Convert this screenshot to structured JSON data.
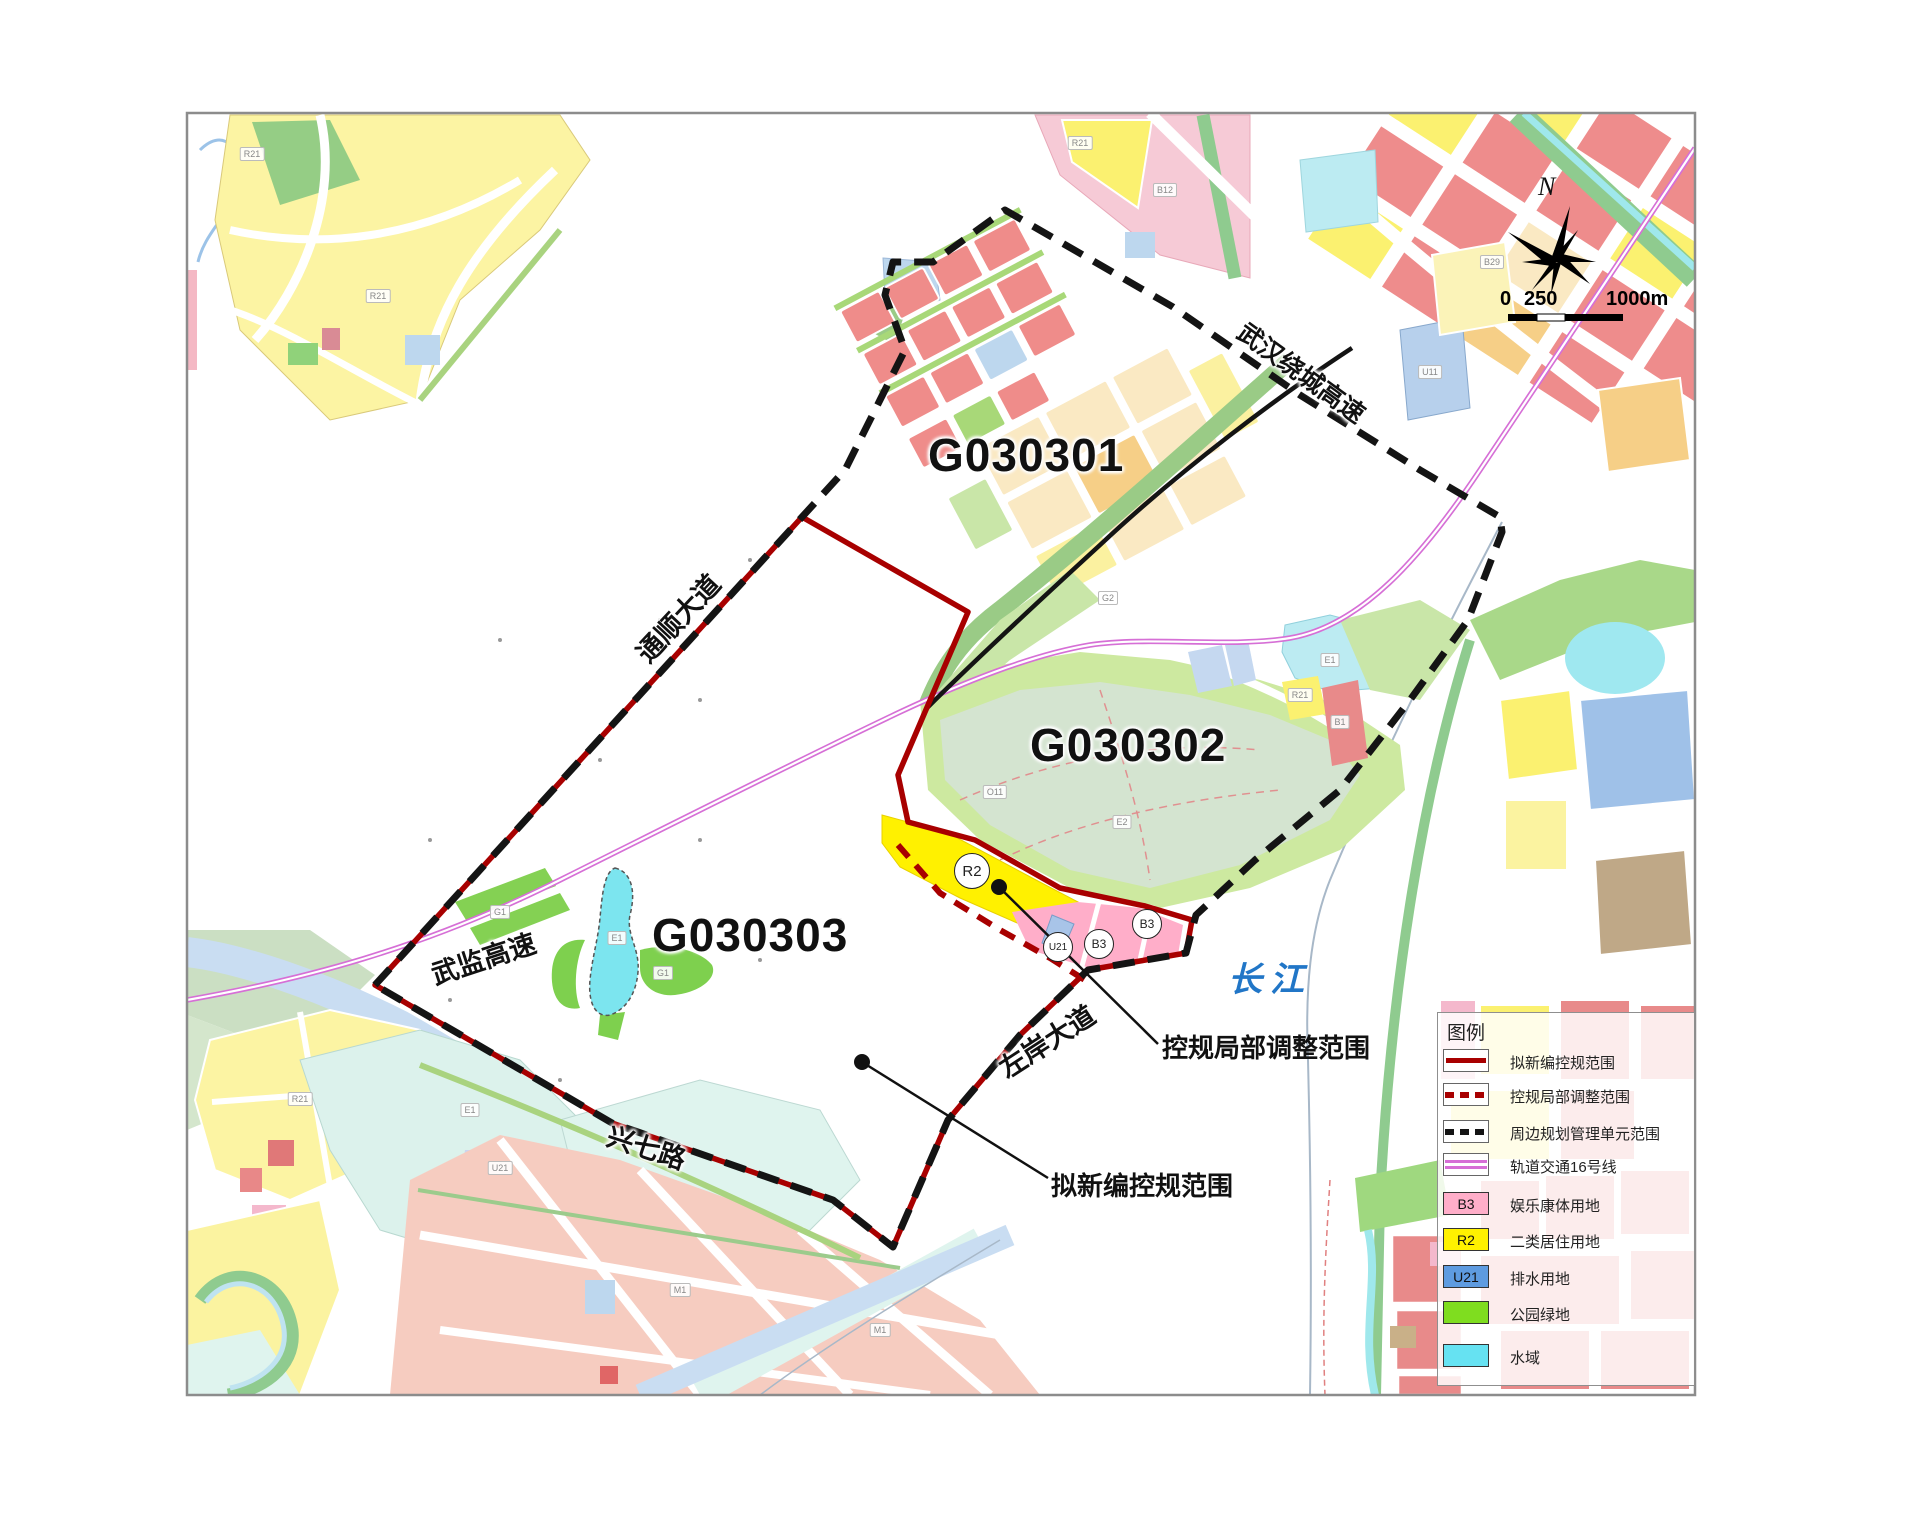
{
  "map": {
    "units": {
      "u1": "G030301",
      "u2": "G030302",
      "u3": "G030303"
    },
    "roads": {
      "tongshun": "通顺大道",
      "wujian": "武监高速",
      "xingqi": "兴七路",
      "zuoan": "左岸大道",
      "raocheng": "武汉绕城高速"
    },
    "river_label": "长江",
    "callouts": {
      "adjust": "控规局部调整范围",
      "new_plan": "拟新编控规范围"
    },
    "badges": {
      "r2": "R2",
      "b3a": "B3",
      "b3b": "B3",
      "u21": "U21"
    },
    "chips": [
      {
        "t": "R21",
        "x": 378,
        "y": 296
      },
      {
        "t": "R21",
        "x": 252,
        "y": 154
      },
      {
        "t": "R21",
        "x": 300,
        "y": 1099
      },
      {
        "t": "R21",
        "x": 1080,
        "y": 143
      },
      {
        "t": "B12",
        "x": 1165,
        "y": 190
      },
      {
        "t": "G2",
        "x": 1108,
        "y": 598
      },
      {
        "t": "E1",
        "x": 617,
        "y": 938
      },
      {
        "t": "G1",
        "x": 663,
        "y": 973
      },
      {
        "t": "G1",
        "x": 500,
        "y": 912
      },
      {
        "t": "E2",
        "x": 1122,
        "y": 822
      },
      {
        "t": "E1",
        "x": 470,
        "y": 1110
      },
      {
        "t": "M1",
        "x": 680,
        "y": 1290
      },
      {
        "t": "M1",
        "x": 880,
        "y": 1330
      },
      {
        "t": "U21",
        "x": 500,
        "y": 1168
      },
      {
        "t": "B29",
        "x": 1492,
        "y": 262
      },
      {
        "t": "U11",
        "x": 1430,
        "y": 372
      },
      {
        "t": "R21",
        "x": 1300,
        "y": 695
      },
      {
        "t": "B1",
        "x": 1340,
        "y": 722
      },
      {
        "t": "O11",
        "x": 995,
        "y": 792
      },
      {
        "t": "E1",
        "x": 1330,
        "y": 660
      }
    ]
  },
  "north_label": "N",
  "scale_bar": {
    "zero": "0",
    "mid": "250",
    "end": "1000m"
  },
  "legend": {
    "title": "图例",
    "items": [
      {
        "label": "拟新编控规范围"
      },
      {
        "label": "控规局部调整范围"
      },
      {
        "label": "周边规划管理单元范围"
      },
      {
        "label": "轨道交通16号线"
      },
      {
        "label": "娱乐康体用地",
        "code": "B3"
      },
      {
        "label": "二类居住用地",
        "code": "R2"
      },
      {
        "label": "排水用地",
        "code": "U21"
      },
      {
        "label": "公园绿地"
      },
      {
        "label": "水域"
      }
    ]
  },
  "colors": {
    "boundary_red": "#A80000",
    "unit_boundary_black": "#141414",
    "rail_magenta": "#D66FD6",
    "b3_pink": "#FFAEC9",
    "r2_yellow": "#FFF100",
    "u21_blue": "#5E9BE0",
    "park_green": "#7FDD1F",
    "water_cyan": "#66E2F2",
    "river_text_blue": "#2176C7"
  }
}
